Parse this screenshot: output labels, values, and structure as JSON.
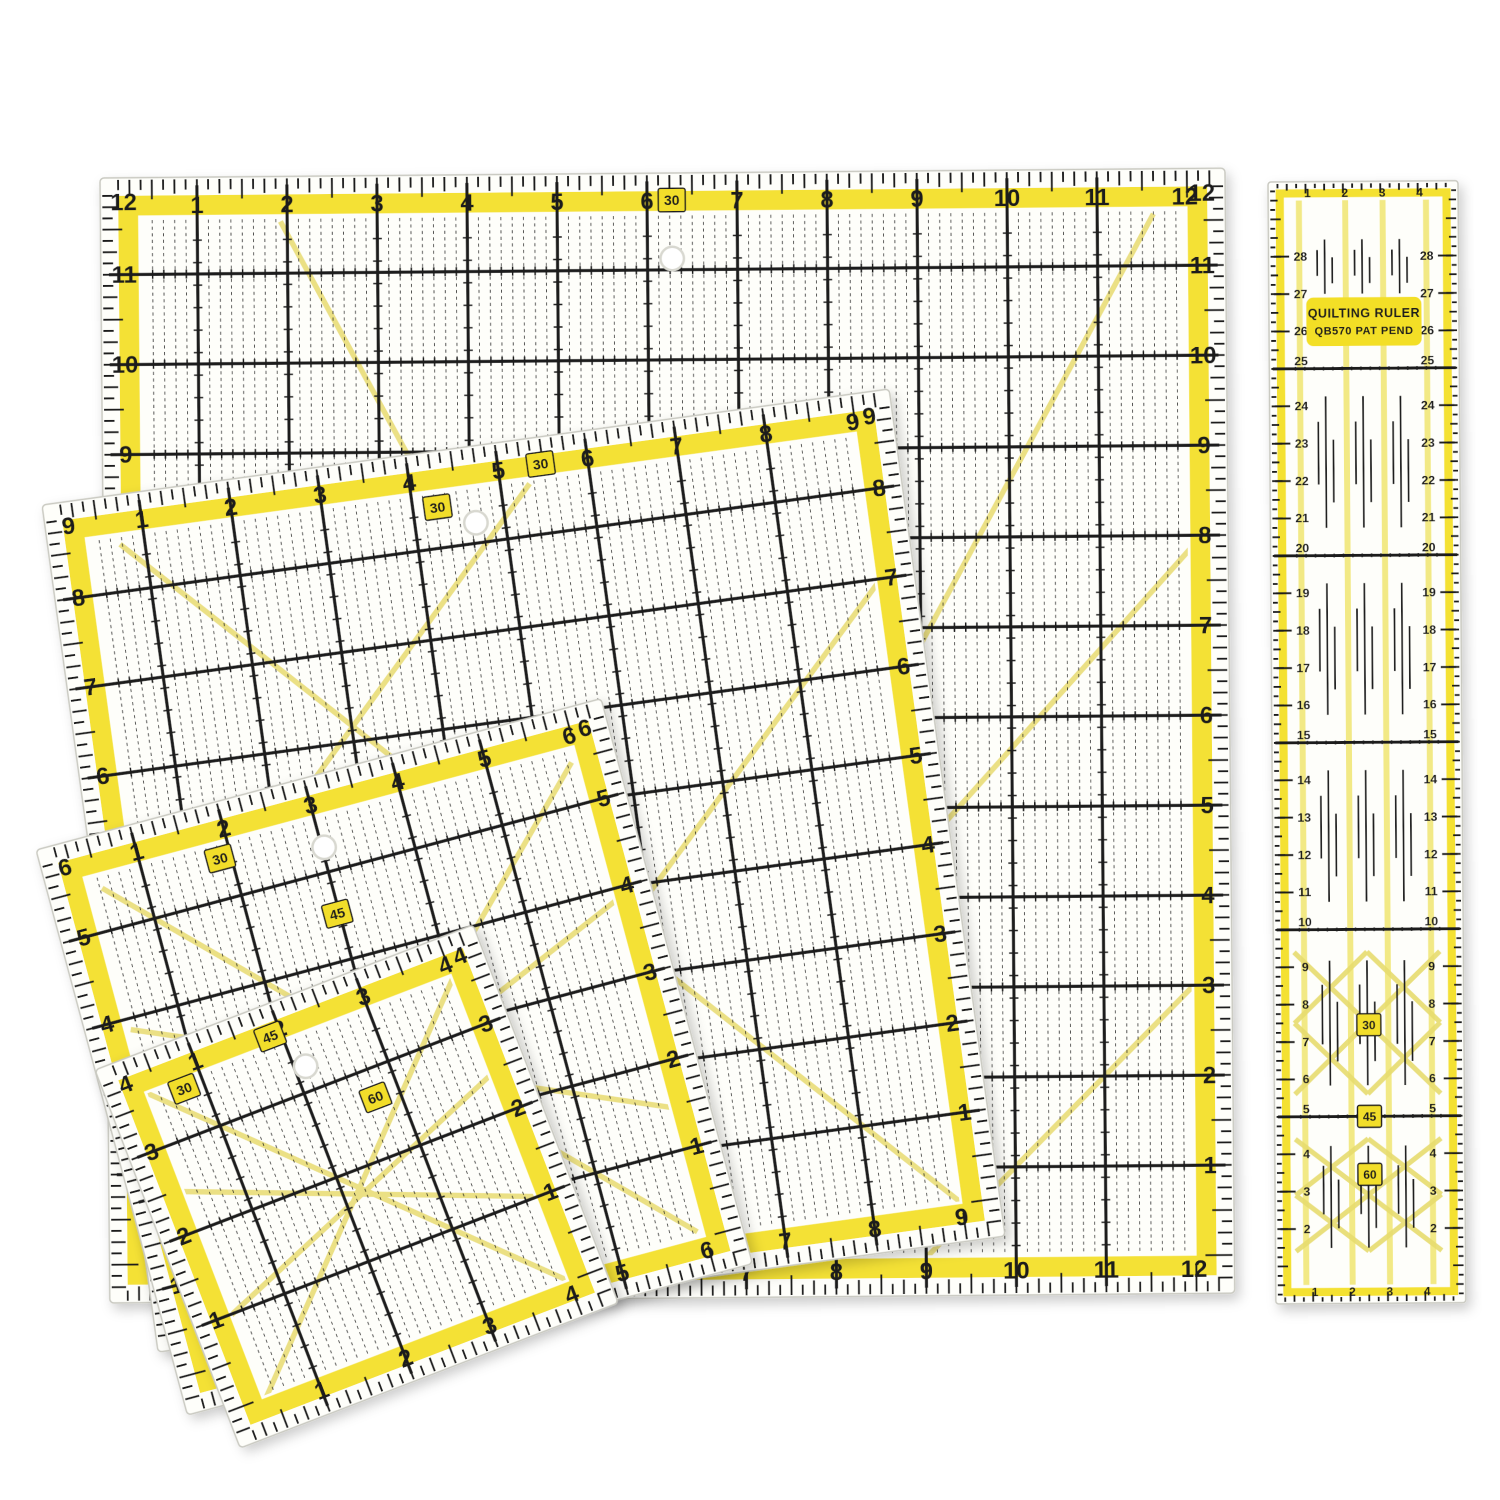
{
  "product": {
    "name": "quilting-acrylic-ruler-set"
  },
  "colors": {
    "background": "#ffffff",
    "body": "#fefefa",
    "edge": "#c9c9c1",
    "frame": "#f3df26",
    "pale": "#e7db6e",
    "column_yellow": "#f1e87e",
    "ink": "#1b1b1b",
    "badge": "#f2de2a",
    "hole_ring": "#d8d8d0"
  },
  "square_rulers": [
    {
      "id": "ruler-12-5-inch-square",
      "nominal": 12,
      "size": 1125,
      "x": 100,
      "y": 178,
      "rotation": -0.5,
      "top_labels": [
        1,
        2,
        3,
        4,
        5,
        6,
        7,
        8,
        9,
        10,
        11,
        12
      ],
      "bottom_labels": [
        1,
        2,
        3,
        4,
        5,
        6,
        7,
        8,
        9,
        10,
        11,
        12
      ],
      "left_labels": [
        12,
        11,
        10,
        9,
        8,
        7,
        6,
        5,
        4,
        3,
        2,
        1
      ],
      "right_labels": [
        12,
        11,
        10,
        9,
        8,
        7,
        6,
        5,
        4,
        3,
        2,
        1
      ],
      "badges": [
        {
          "text": "30",
          "x": 6.35,
          "y": 0.3
        }
      ],
      "hole": {
        "x": 6.35,
        "y": 0.95
      },
      "diagonals": [
        [
          2.0,
          0.5,
          8.2,
          12.1
        ],
        [
          11.7,
          0.5,
          5.3,
          12.1
        ],
        [
          4.9,
          12.1,
          12.1,
          4.2
        ],
        [
          8.9,
          12.25,
          12.3,
          8.85
        ]
      ]
    },
    {
      "id": "ruler-9-5-inch-square",
      "nominal": 9,
      "size": 855,
      "x": 42,
      "y": 505,
      "rotation": -7.8,
      "top_labels": [
        1,
        2,
        3,
        4,
        5,
        6,
        7,
        8,
        9
      ],
      "bottom_labels": [
        1,
        2,
        3,
        4,
        5,
        6,
        7,
        8,
        9
      ],
      "left_labels": [
        9,
        8,
        7,
        6,
        5,
        4,
        3,
        2,
        1
      ],
      "right_labels": [
        9,
        8,
        7,
        6,
        5,
        4,
        3,
        2,
        1
      ],
      "badges": [
        {
          "text": "30",
          "x": 4.35,
          "y": 0.62
        },
        {
          "text": "30",
          "x": 5.55,
          "y": 0.3
        }
      ],
      "hole": {
        "x": 4.75,
        "y": 0.85
      },
      "diagonals": [
        [
          0.8,
          0.55,
          9.1,
          9.1
        ],
        [
          5.4,
          0.5,
          0.5,
          5.6
        ],
        [
          9.1,
          2.1,
          2.2,
          9.2
        ],
        [
          0.5,
          6.8,
          3.2,
          9.3
        ]
      ]
    },
    {
      "id": "ruler-6-5-inch-square",
      "nominal": 6,
      "size": 585,
      "x": 36,
      "y": 850,
      "rotation": -15,
      "top_labels": [
        1,
        2,
        3,
        4,
        5,
        6
      ],
      "bottom_labels": [
        1,
        2,
        3,
        4,
        5,
        6
      ],
      "left_labels": [
        6,
        5,
        4,
        3,
        2,
        1
      ],
      "right_labels": [
        6,
        5,
        4,
        3,
        2,
        1
      ],
      "badges": [
        {
          "text": "30",
          "x": 1.95,
          "y": 0.62
        },
        {
          "text": "45",
          "x": 3.05,
          "y": 1.55
        },
        {
          "text": "60",
          "x": 2.1,
          "y": 3.1
        }
      ],
      "hole": {
        "x": 3.1,
        "y": 0.8
      },
      "diagonals": [
        [
          0.6,
          0.6,
          6.0,
          6.0
        ],
        [
          6.0,
          0.6,
          0.6,
          6.0
        ],
        [
          0.5,
          2.2,
          6.1,
          4.6
        ],
        [
          0.5,
          4.6,
          6.1,
          2.2
        ]
      ]
    },
    {
      "id": "ruler-4-5-inch-square",
      "nominal": 4,
      "size": 405,
      "x": 95,
      "y": 1070,
      "rotation": -21,
      "top_labels": [
        1,
        2,
        3,
        4
      ],
      "bottom_labels": [
        1,
        2,
        3,
        4
      ],
      "left_labels": [
        4,
        3,
        2,
        1
      ],
      "right_labels": [
        4,
        3,
        2,
        1
      ],
      "badges": [
        {
          "text": "30",
          "x": 0.85,
          "y": 0.55
        },
        {
          "text": "45",
          "x": 1.95,
          "y": 0.35
        },
        {
          "text": "60",
          "x": 2.8,
          "y": 1.4
        }
      ],
      "hole": {
        "x": 2.2,
        "y": 0.8
      },
      "diagonals": [
        [
          0.45,
          0.45,
          4.1,
          4.1
        ],
        [
          4.1,
          0.45,
          0.45,
          4.1
        ],
        [
          0.4,
          1.6,
          4.15,
          3.1
        ],
        [
          0.4,
          3.1,
          4.15,
          1.6
        ]
      ]
    }
  ],
  "long_ruler": {
    "id": "ruler-30cm-strip",
    "x": 1268,
    "y": 182,
    "rotation": -0.4,
    "width": 190,
    "height": 1122,
    "title": {
      "line1": "QUILTING RULER",
      "line2": "QB570  PAT PEND"
    },
    "top_labels": [
      1,
      2,
      3,
      4
    ],
    "bottom_labels": [
      1,
      2,
      3,
      4
    ],
    "row_values": [
      28,
      27,
      26,
      25,
      24,
      23,
      22,
      21,
      20,
      19,
      18,
      17,
      16,
      15,
      14,
      13,
      12,
      11,
      10,
      9,
      8,
      7,
      6,
      5,
      4,
      3,
      2
    ],
    "section_lines": [
      5,
      10,
      15,
      20,
      25
    ],
    "badges": [
      {
        "text": "30",
        "cm": 7.45
      },
      {
        "text": "45",
        "cm": 5.0
      },
      {
        "text": "60",
        "cm": 3.45
      }
    ],
    "yellow_columns": [
      0.82,
      2.06,
      3.06,
      4.22
    ],
    "cluster_blocks": [
      [
        26.9,
        28.55
      ],
      [
        20.5,
        24.5
      ],
      [
        15.5,
        19.5
      ],
      [
        10.5,
        14.5
      ],
      [
        5.6,
        9.4
      ],
      [
        1.3,
        4.4
      ]
    ],
    "diagonals": [
      [
        0.55,
        5.6,
        4.45,
        9.4
      ],
      [
        0.55,
        9.4,
        4.45,
        5.6
      ],
      [
        0.55,
        7.5,
        2.5,
        5.6
      ],
      [
        2.5,
        5.6,
        4.45,
        7.5
      ],
      [
        0.55,
        7.5,
        2.5,
        9.4
      ],
      [
        2.5,
        9.4,
        4.45,
        7.5
      ],
      [
        0.55,
        1.4,
        4.45,
        4.4
      ],
      [
        0.55,
        4.4,
        4.45,
        1.4
      ],
      [
        0.55,
        2.9,
        2.5,
        1.4
      ],
      [
        2.5,
        1.4,
        4.45,
        2.9
      ],
      [
        0.55,
        2.9,
        2.5,
        4.4
      ],
      [
        2.5,
        4.4,
        4.45,
        2.9
      ]
    ]
  }
}
